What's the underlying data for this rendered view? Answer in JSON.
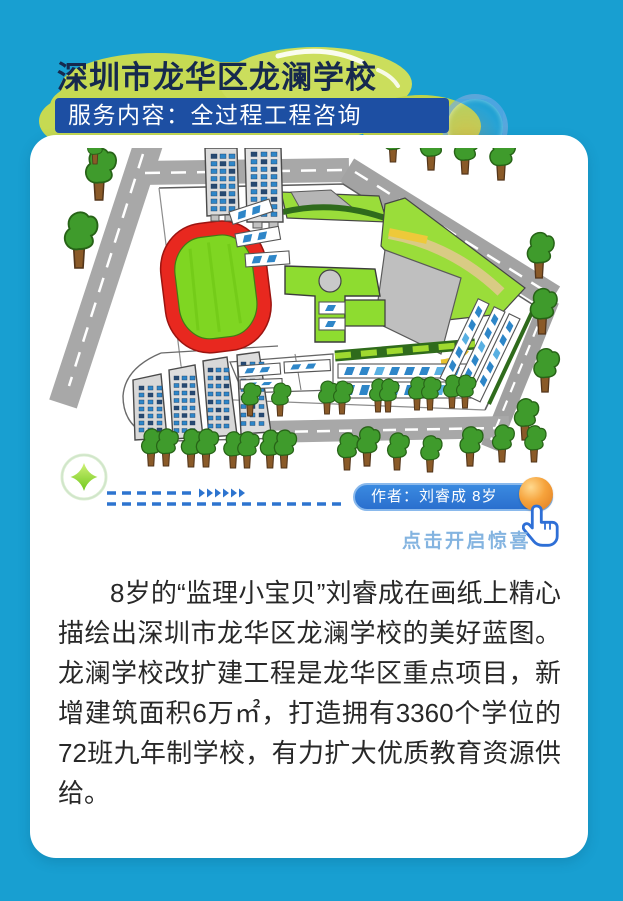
{
  "header": {
    "title": "深圳市龙华区龙澜学校",
    "subtitle": "服务内容：全过程工程咨询"
  },
  "drawing": {
    "caption_author": "作者：刘睿成 8岁",
    "hint": "点击开启惊喜"
  },
  "article": {
    "paragraph": "8岁的“监理小宝贝”刘睿成在画纸上精心描绘出深圳市龙华区龙澜学校的美好蓝图。龙澜学校改扩建工程是龙华区重点项目，新增建筑面积6万㎡，打造拥有3360个学位的72班九年制学校，有力扩大优质教育资源供给。"
  },
  "colors": {
    "background_cyan": "#189fd1",
    "cloud_green": "#c6da52",
    "title_navy": "#16294e",
    "banner_blue": "#1d4fa3",
    "caption_pill_blue": "#2b7cd8",
    "ball_orange": "#f59b2e",
    "hint_blue": "#7aaede",
    "dash_blue": "#2d74cf",
    "track_red": "#e8281f",
    "field_green": "#7fd622",
    "lawn_green": "#97dc3a"
  }
}
